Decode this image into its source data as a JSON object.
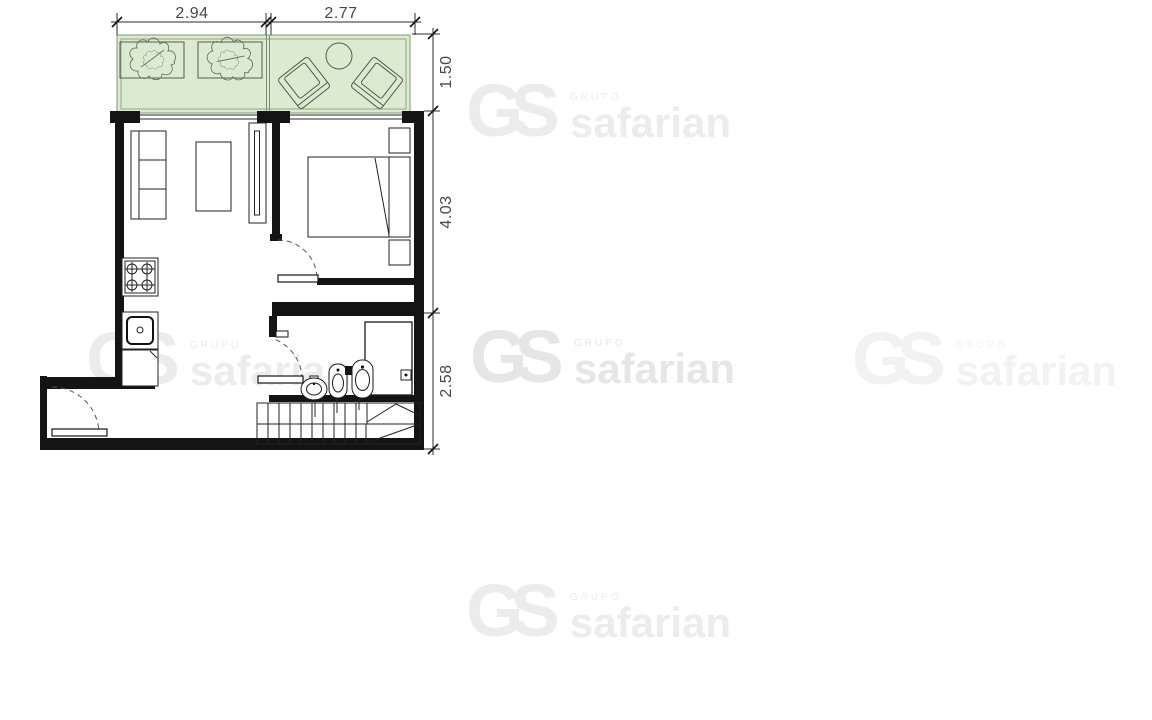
{
  "page": {
    "kind": "architectural-floor-plan",
    "background": "#ffffff"
  },
  "dimensions": {
    "top": [
      {
        "label": "2.94"
      },
      {
        "label": "2.77"
      }
    ],
    "right": [
      {
        "label": "1.50"
      },
      {
        "label": "4.03"
      },
      {
        "label": "2.58"
      }
    ]
  },
  "watermark": {
    "monogram": "GS",
    "group_word": "GRUPO",
    "brand": "safarian"
  },
  "plan": {
    "rooms": [
      "terrace",
      "living-room",
      "bedroom",
      "kitchen",
      "hall",
      "bathroom",
      "stairs"
    ],
    "fixtures": [
      "planter-trees",
      "terrace-armchairs",
      "terrace-round-table",
      "sofa",
      "coffee-table",
      "tv-unit",
      "double-bed",
      "nightstands",
      "stove",
      "kitchen-sink",
      "base-cabinet",
      "shower",
      "wash-basin",
      "bidet",
      "toilet",
      "staircase",
      "entry-door",
      "bedroom-door",
      "bathroom-door"
    ]
  },
  "colors": {
    "wall": "#141414",
    "terrace_fill": "#dcead2",
    "terrace_line": "#93a884",
    "dimension_text": "#474747",
    "watermark_light": "#ececec",
    "watermark_mid": "#e6e6e6",
    "watermark_faint": "#f2f2f2"
  }
}
